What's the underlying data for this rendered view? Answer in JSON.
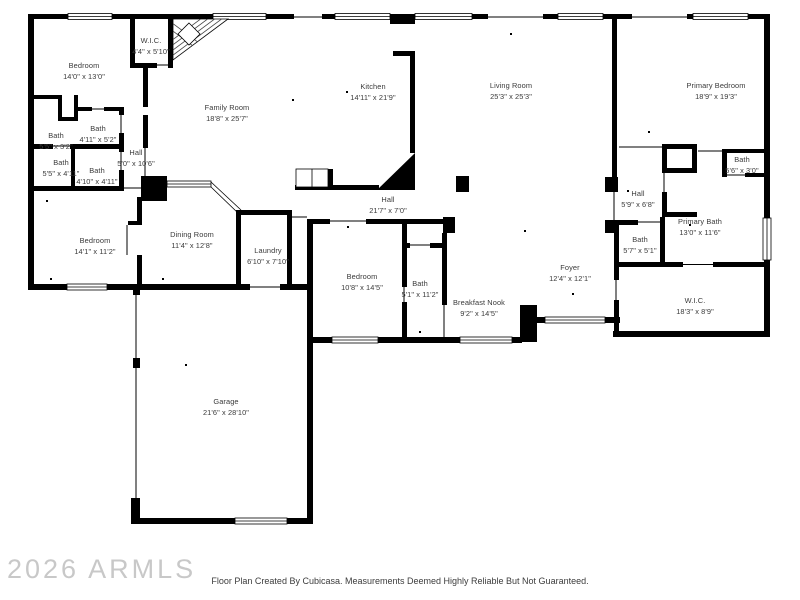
{
  "meta": {
    "watermark": "2026 ARMLS",
    "footer": "Floor Plan Created By Cubicasa. Measurements Deemed Highly Reliable But Not Guaranteed."
  },
  "colors": {
    "wall": "#000000",
    "label": "#3a3a3a",
    "watermark": "#c8c8c8",
    "background": "#ffffff"
  },
  "rooms": [
    {
      "name": "W.I.C.",
      "dims": "4'4\" x 5'10\"",
      "x": 151,
      "y": 47
    },
    {
      "name": "Bedroom",
      "dims": "14'0\" x 13'0\"",
      "x": 84,
      "y": 72
    },
    {
      "name": "Family Room",
      "dims": "18'8\" x 25'7\"",
      "x": 227,
      "y": 114
    },
    {
      "name": "Kitchen",
      "dims": "14'11\" x 21'9\"",
      "x": 373,
      "y": 93
    },
    {
      "name": "Living Room",
      "dims": "25'3\" x 25'3\"",
      "x": 511,
      "y": 92
    },
    {
      "name": "Primary Bedroom",
      "dims": "18'9\" x 19'3\"",
      "x": 716,
      "y": 92
    },
    {
      "name": "Bath",
      "dims": "4'11\" x 5'2\"",
      "x": 98,
      "y": 135
    },
    {
      "name": "Bath",
      "dims": "5'5\" x 3'2\"",
      "x": 56,
      "y": 142
    },
    {
      "name": "Bath",
      "dims": "5'5\" x 4'11\"",
      "x": 61,
      "y": 169
    },
    {
      "name": "Bath",
      "dims": "4'10\" x 4'11\"",
      "x": 97,
      "y": 177
    },
    {
      "name": "Hall",
      "dims": "5'0\" x 10'6\"",
      "x": 136,
      "y": 159
    },
    {
      "name": "Bedroom",
      "dims": "14'1\" x 11'2\"",
      "x": 95,
      "y": 247
    },
    {
      "name": "Dining Room",
      "dims": "11'4\" x 12'8\"",
      "x": 192,
      "y": 241
    },
    {
      "name": "Laundry",
      "dims": "6'10\" x 7'10\"",
      "x": 268,
      "y": 257
    },
    {
      "name": "Hall",
      "dims": "21'7\" x 7'0\"",
      "x": 388,
      "y": 206
    },
    {
      "name": "Bedroom",
      "dims": "10'8\" x 14'5\"",
      "x": 362,
      "y": 283
    },
    {
      "name": "Bath",
      "dims": "5'1\" x 11'2\"",
      "x": 420,
      "y": 290
    },
    {
      "name": "Breakfast Nook",
      "dims": "9'2\" x 14'5\"",
      "x": 479,
      "y": 309
    },
    {
      "name": "Foyer",
      "dims": "12'4\" x 12'1\"",
      "x": 570,
      "y": 274
    },
    {
      "name": "Hall",
      "dims": "5'9\" x 6'8\"",
      "x": 638,
      "y": 200
    },
    {
      "name": "Bath",
      "dims": "5'6\" x 3'0\"",
      "x": 742,
      "y": 166
    },
    {
      "name": "Primary Bath",
      "dims": "13'0\" x 11'6\"",
      "x": 700,
      "y": 228
    },
    {
      "name": "Bath",
      "dims": "5'7\" x 5'1\"",
      "x": 640,
      "y": 246
    },
    {
      "name": "W.I.C.",
      "dims": "18'3\" x 8'9\"",
      "x": 695,
      "y": 307
    },
    {
      "name": "Garage",
      "dims": "21'6\" x 28'10\"",
      "x": 226,
      "y": 408
    }
  ]
}
